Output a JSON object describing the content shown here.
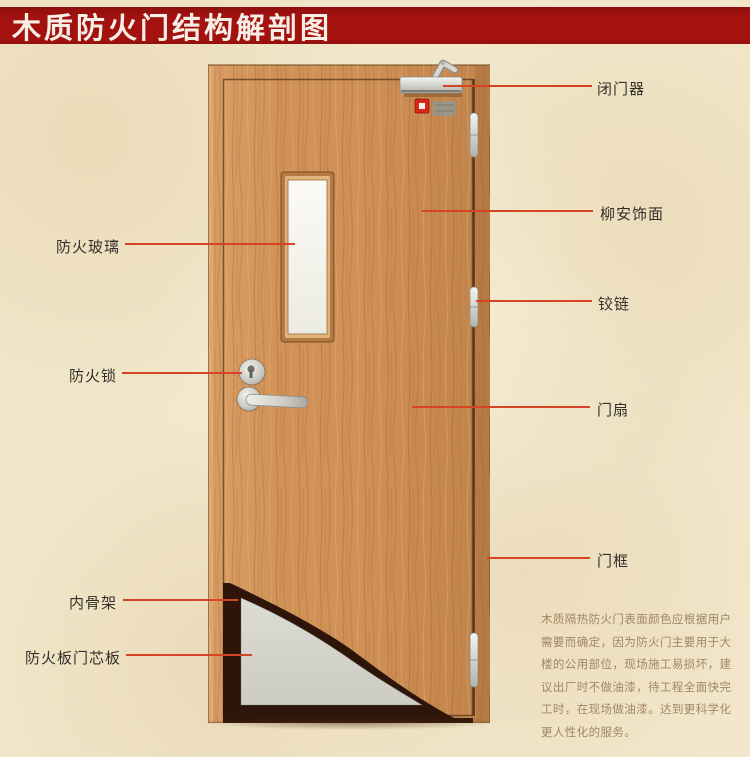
{
  "title": "木质防火门结构解剖图",
  "labels": {
    "left": [
      {
        "id": "fire-glass",
        "text": "防火玻璃"
      },
      {
        "id": "fire-lock",
        "text": "防火锁"
      },
      {
        "id": "inner-skeleton",
        "text": "内骨架"
      },
      {
        "id": "fire-board-core",
        "text": "防火板门芯板"
      }
    ],
    "right": [
      {
        "id": "door-closer",
        "text": "闭门器"
      },
      {
        "id": "lauan-veneer",
        "text": "柳安饰面"
      },
      {
        "id": "hinge",
        "text": "铰链"
      },
      {
        "id": "door-leaf",
        "text": "门扇"
      },
      {
        "id": "door-frame",
        "text": "门框"
      }
    ]
  },
  "description": {
    "lines": [
      "木质隔热防火门表面颜色应根据用户",
      "需要而确定，因为防火门主要用于大",
      "楼的公用部位，现场施工易损坏，建",
      "议出厂时不做油漆，待工程全面快完",
      "工时，在现场做油漆。达到更科学化",
      "更人性化的服务。"
    ]
  },
  "parts": [
    "door-frame",
    "door-leaf",
    "fire-glass-window",
    "door-closer",
    "fire-alarm-indicator",
    "mounting-bracket",
    "hinge-top",
    "hinge-middle",
    "hinge-bottom",
    "fire-lock-keyhole",
    "lever-handle",
    "inner-skeleton",
    "fire-board-core",
    "floor-shadow"
  ],
  "colors": {
    "background": "#f2e7cb",
    "banner_red": "#a41210",
    "banner_text": "#f7efe6",
    "leader_line": "#d64426",
    "label_text": "#33302b",
    "description_text": "#a18764",
    "wood": "#cf9158",
    "skeleton_dark": "#2e150a",
    "core_board_gray": "#d4d3cc",
    "glass_white": "#f8f7f2",
    "metal_silver": "#d9d9d3",
    "indicator_red": "#d6281c"
  }
}
